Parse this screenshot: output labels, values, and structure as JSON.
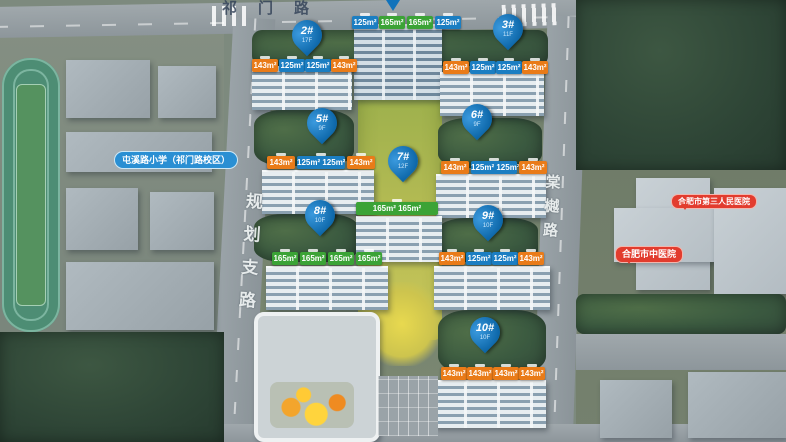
{
  "roads": {
    "top": "祁门路",
    "left": "规划支路",
    "right": "棠樾路"
  },
  "pois": {
    "school": "屯溪路小学（祁门路校区）",
    "hospital_third": "合肥市第三人民医院",
    "hospital_tcm": "合肥市中医院"
  },
  "markers": [
    {
      "label": "2#",
      "floors": "17F"
    },
    {
      "label": "3#",
      "floors": "11F"
    },
    {
      "label": "5#",
      "floors": "9F"
    },
    {
      "label": "6#",
      "floors": "9F"
    },
    {
      "label": "7#",
      "floors": "12F"
    },
    {
      "label": "8#",
      "floors": "10F"
    },
    {
      "label": "9#",
      "floors": "10F"
    },
    {
      "label": "10#",
      "floors": "10F"
    }
  ],
  "unit_tags": {
    "r1": {
      "building": "1#",
      "items": [
        {
          "v": "125m²"
        },
        {
          "v": "165m²"
        },
        {
          "v": "165m²"
        },
        {
          "v": "125m²"
        }
      ]
    },
    "r2": {
      "building": "2#",
      "items": [
        {
          "v": "143m²"
        },
        {
          "v": "125m²"
        },
        {
          "v": "125m²"
        },
        {
          "v": "143m²"
        }
      ]
    },
    "r3": {
      "building": "3#",
      "items": [
        {
          "v": "143m²"
        },
        {
          "v": "125m²"
        },
        {
          "v": "125m²"
        },
        {
          "v": "143m²"
        }
      ]
    },
    "r5": {
      "building": "5#",
      "items": [
        {
          "v": "143m²"
        },
        {
          "v": "125m² 125m²"
        },
        {
          "v": "143m²"
        }
      ]
    },
    "r6": {
      "building": "6#",
      "items": [
        {
          "v": "143m²"
        },
        {
          "v": "125m² 125m²"
        },
        {
          "v": "143m²"
        }
      ]
    },
    "r7": {
      "building": "7#",
      "items": [
        {
          "v": "165m² 165m²"
        }
      ]
    },
    "r8": {
      "building": "8#",
      "items": [
        {
          "v": "165m²"
        },
        {
          "v": "165m²"
        },
        {
          "v": "165m²"
        },
        {
          "v": "165m²"
        }
      ]
    },
    "r9": {
      "building": "9#",
      "items": [
        {
          "v": "143m²"
        },
        {
          "v": "125m²"
        },
        {
          "v": "125m²"
        },
        {
          "v": "143m²"
        }
      ]
    },
    "r10": {
      "building": "10#",
      "items": [
        {
          "v": "143m²"
        },
        {
          "v": "143m²"
        },
        {
          "v": "143m²"
        },
        {
          "v": "143m²"
        }
      ]
    }
  },
  "colors": {
    "pin_blue": "#0f6cb0",
    "tag_orange": "#e97b18",
    "tag_blue": "#1b7ec2",
    "tag_green": "#3ba336",
    "poi_blue": "#2a8fd3",
    "poi_red": "#e23c2e"
  }
}
